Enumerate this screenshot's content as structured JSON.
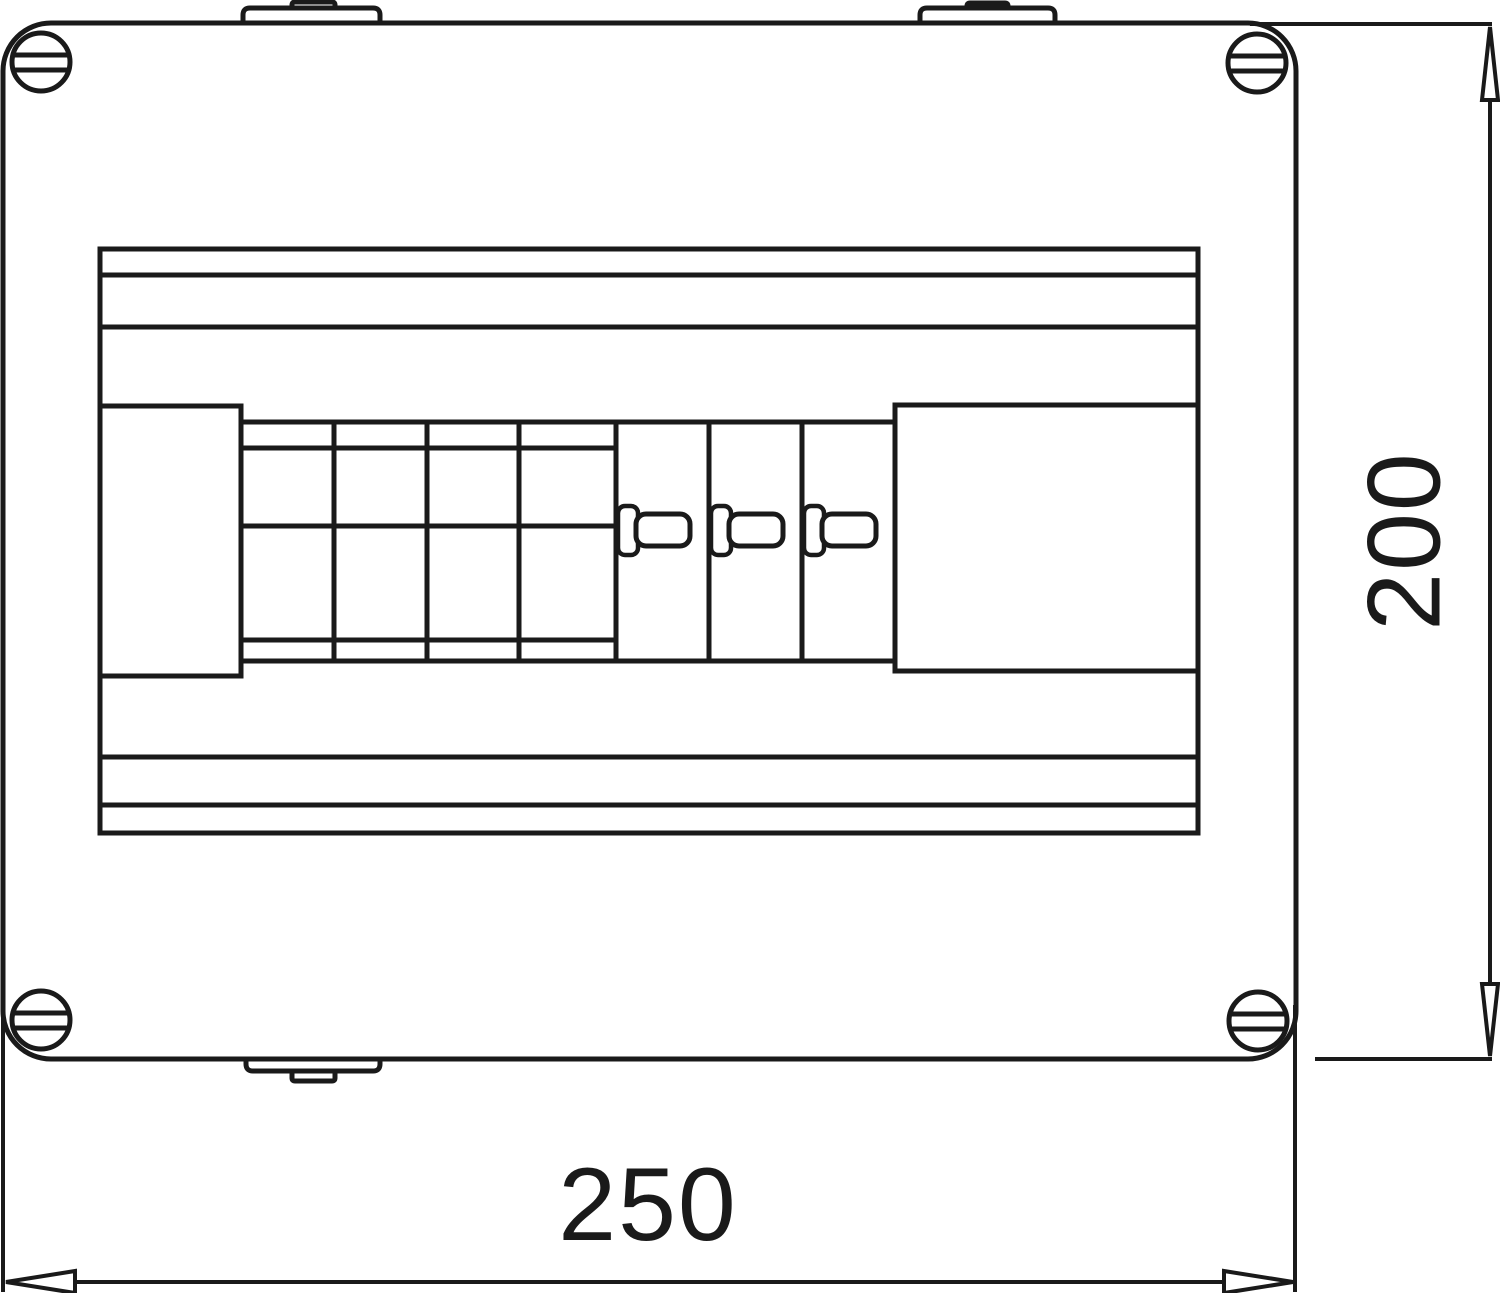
{
  "drawing": {
    "type": "technical-drawing",
    "view": "front view of surface-mount enclosure with DIN modules",
    "dimension_labels": {
      "width": "250",
      "height": "200"
    },
    "colors": {
      "line": "#1a1a1a",
      "background": "#ffffff"
    },
    "component_counts": {
      "corner_screws": 4,
      "top_mounting_tabs": 2,
      "bottom_mounting_tabs": 1,
      "module_cells": 7,
      "toggle_switches": 3
    }
  }
}
